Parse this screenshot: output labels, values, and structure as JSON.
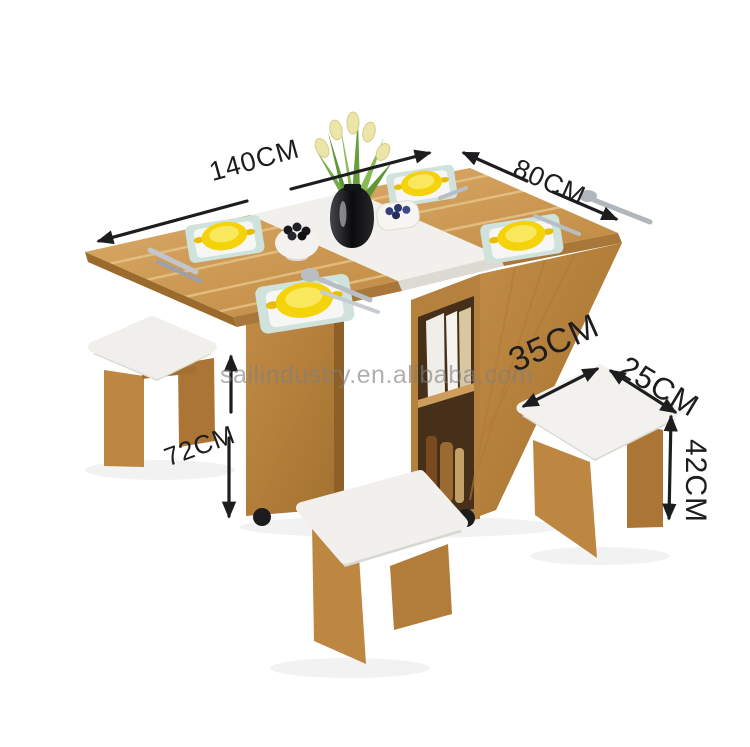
{
  "page": {
    "background": "#ffffff",
    "kind": "furniture product dimension photo"
  },
  "watermark": {
    "text": "sailindustry.en.alibaba.com",
    "color": "#808080"
  },
  "annotations": {
    "color": "#1d1d1f",
    "table": {
      "length": "140CM",
      "width": "80CM",
      "height": "72CM"
    },
    "stool": {
      "length": "35CM",
      "width": "25CM",
      "height": "42CM"
    }
  },
  "scene": {
    "objects": [
      "folding-dining-table",
      "white-center-panel",
      "storage-shelf-with-books",
      "caster-wheels",
      "left-stool",
      "front-stool",
      "right-stool",
      "black-flower-vase",
      "calla-lily-flowers",
      "yellow-bowls",
      "square-plates",
      "berry-bowl",
      "heart-fruit-bowl",
      "cutlery"
    ],
    "colors": {
      "wood": "#c6934f",
      "wood_dark": "#a0702e",
      "white_panel": "#f1f0ec",
      "stool_seat": "#f1f0ec",
      "bowl_yellow": "#f5d30a",
      "plate_rim": "#cfe2dc",
      "leaf_green": "#679f3c",
      "vase_black": "#141416",
      "berries_blue": "#33427a",
      "caster_black": "#1c1c1e"
    }
  }
}
